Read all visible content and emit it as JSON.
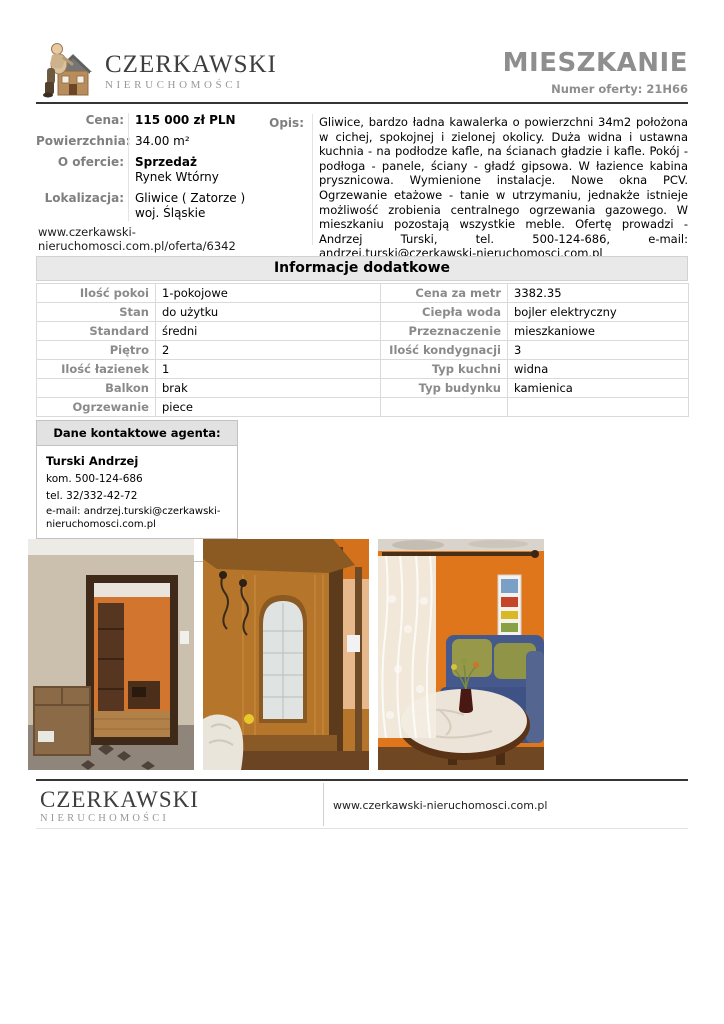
{
  "header": {
    "brand": "CZERKAWSKI",
    "brand_sub": "NIERUCHOMOŚCI",
    "title": "MIESZKANIE",
    "offer_number": "Numer oferty: 21H66"
  },
  "summary": {
    "price_label": "Cena:",
    "price_value": "115 000 zł PLN",
    "area_label": "Powierzchnia:",
    "area_value": "34.00 m²",
    "offer_label": "O ofercie:",
    "offer_type": "Sprzedaż",
    "offer_market": "Rynek Wtórny",
    "location_label": "Lokalizacja:",
    "location_city": "Gliwice ( Zatorze )",
    "location_region": "woj. Śląskie",
    "listing_url_line1": "www.czerkawski-",
    "listing_url_line2": "nieruchomosci.com.pl/oferta/6342"
  },
  "description": {
    "label": "Opis:",
    "text": "Gliwice, bardzo ładna kawalerka o powierzchni 34m2 położona w cichej, spokojnej i zielonej okolicy. Duża widna i ustawna kuchnia - na podłodze kafle, na ścianach gładzie i kafle. Pokój - podłoga - panele, ściany - gładź gipsowa. W łazience kabina prysznicowa. Wymienione instalacje. Nowe okna PCV. Ogrzewanie etażowe - tanie w utrzymaniu, jednakże istnieje możliwość zrobienia centralnego ogrzewania gazowego. W mieszkaniu pozostają wszystkie meble. Ofertę prowadzi - Andrzej Turski, tel. 500-124-686, e-mail: andrzej.turski@czerkawski-nieruchomosci.com.pl"
  },
  "additional_info": {
    "title": "Informacje dodatkowe",
    "rows": [
      {
        "left_label": "Ilość pokoi",
        "left_value": "1-pokojowe",
        "right_label": "Cena za metr",
        "right_value": "3382.35"
      },
      {
        "left_label": "Stan",
        "left_value": "do użytku",
        "right_label": "Ciepła woda",
        "right_value": "bojler elektryczny"
      },
      {
        "left_label": "Standard",
        "left_value": "średni",
        "right_label": "Przeznaczenie",
        "right_value": "mieszkaniowe"
      },
      {
        "left_label": "Piętro",
        "left_value": "2",
        "right_label": "Ilość kondygnacji",
        "right_value": "3"
      },
      {
        "left_label": "Ilość łazienek",
        "left_value": "1",
        "right_label": "Typ kuchni",
        "right_value": "widna"
      },
      {
        "left_label": "Balkon",
        "left_value": "brak",
        "right_label": "Typ budynku",
        "right_value": "kamienica"
      },
      {
        "left_label": "Ogrzewanie",
        "left_value": "piece",
        "right_label": "",
        "right_value": ""
      }
    ]
  },
  "agent": {
    "box_title": "Dane kontaktowe agenta:",
    "name": "Turski Andrzej",
    "mobile": "kom. 500-124-686",
    "phone": "tel. 32/332-42-72",
    "email": "e-mail: andrzej.turski@czerkawski-nieruchomosci.com.pl",
    "license": "Nr licencji: 17148"
  },
  "photos": [
    {
      "alt": "room with open dark door to orange room, cardboard box, patterned tile floor"
    },
    {
      "alt": "hallway wardrobe in oak wood with arched mirror, orange wall"
    },
    {
      "alt": "living room with orange walls, lace curtain, blue sofa, oval table with white cloth"
    }
  ],
  "footer": {
    "brand": "CZERKAWSKI",
    "brand_sub": "NIERUCHOMOŚCI",
    "website": "www.czerkawski-nieruchomosci.com.pl"
  },
  "colors": {
    "title_gray": "#8e8e8e",
    "label_gray": "#7f7f7f",
    "table_header_bg": "#e9e9e9",
    "border_light": "#dadada",
    "rule_dark": "#353535",
    "photo_orange": "#e0761c"
  }
}
